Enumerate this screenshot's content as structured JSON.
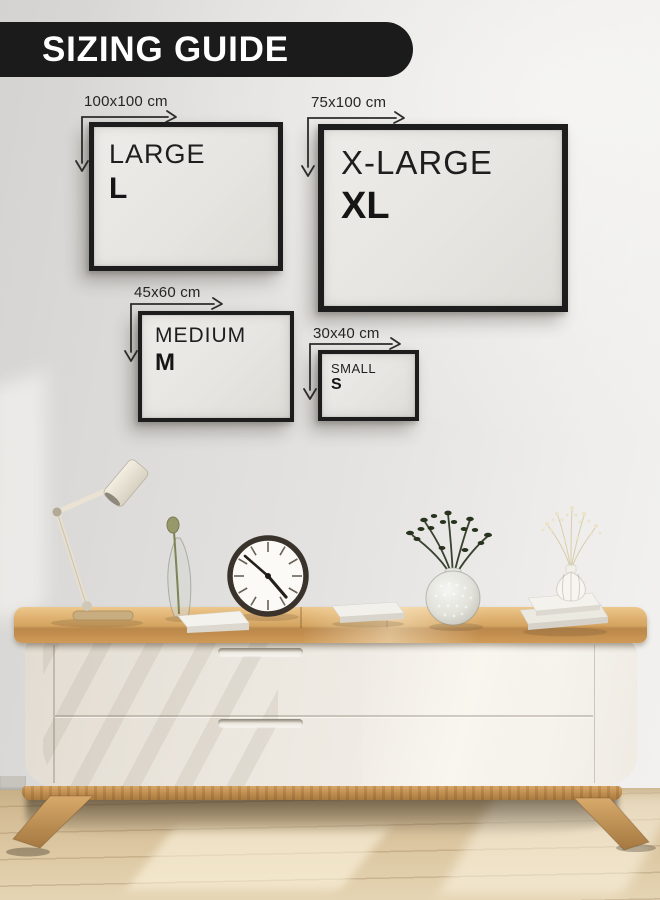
{
  "header": {
    "title": "SIZING GUIDE"
  },
  "sizes": [
    {
      "name": "LARGE",
      "abbr": "L",
      "dimensions": "100x100 cm"
    },
    {
      "name": "X-LARGE",
      "abbr": "XL",
      "dimensions": "75x100 cm"
    },
    {
      "name": "MEDIUM",
      "abbr": "M",
      "dimensions": "45x60 cm"
    },
    {
      "name": "SMALL",
      "abbr": "S",
      "dimensions": "30x40 cm"
    }
  ],
  "colors": {
    "banner_bg": "#1b1b1b",
    "banner_text": "#ffffff",
    "frame_border": "#1d1d1d",
    "frame_canvas": "#e8e6e2",
    "label_text": "#262626",
    "wall": "#e0dfdd",
    "wood_top": "#d3a35f",
    "cabinet_front": "#efebe4",
    "floor": "#d9c49e"
  },
  "scene": {
    "decor": [
      "desk-lamp",
      "bud-vase",
      "wall-clock",
      "books",
      "bubble-vase-plant",
      "ribbed-vase-flowers",
      "sideboard"
    ]
  }
}
